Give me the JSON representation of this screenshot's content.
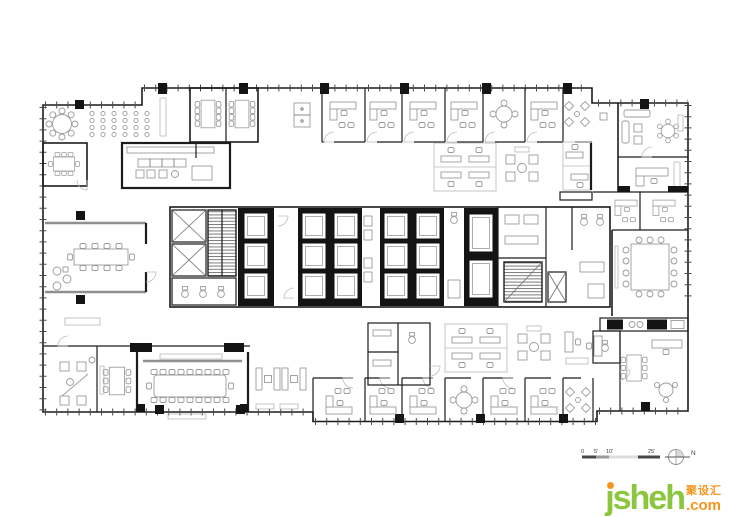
{
  "meta": {
    "type": "architectural-floor-plan",
    "description": "Office tower typical floor plan: central service core with four elevator banks and two stairwells, perimeter private offices, two conference rooms, boardroom, cafeteria and open lounge areas. No room labels printed on plan."
  },
  "scale_bar": {
    "labels": [
      "0",
      "5'",
      "10'",
      "25'"
    ]
  },
  "north_arrow": {
    "label": "N"
  },
  "watermark": {
    "brand": "jsheh",
    "suffix": ".com",
    "chinese": "聚设汇",
    "brand_color": "#8cc63f",
    "accent_color": "#f7941d"
  },
  "palette": {
    "background": "#ffffff",
    "wall": "#1c1c1c",
    "furniture": "#9b9b9b",
    "glass_partition": "#8f8f8f",
    "core_fill": "#141414"
  }
}
